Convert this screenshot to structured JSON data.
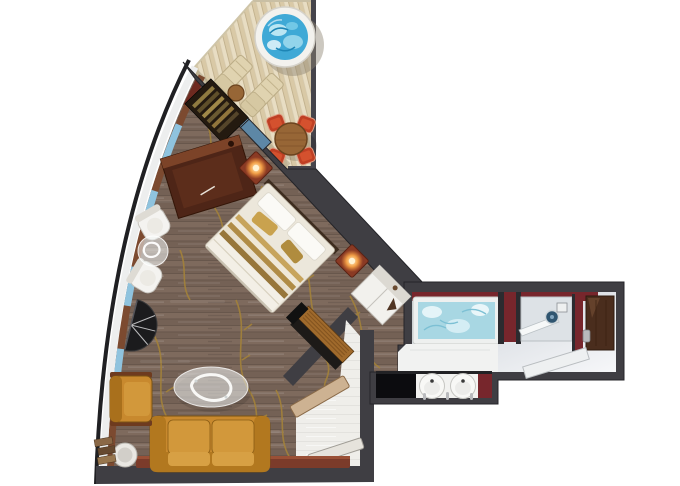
{
  "plan": {
    "type": "cruise-suite-floor-plan",
    "rooms": [
      "balcony",
      "living-bedroom",
      "entry-hall",
      "bathroom"
    ],
    "furniture": {
      "balcony": [
        "hot-tub",
        "sun-lounger",
        "sun-lounger",
        "patio-side-table",
        "dining-table",
        "patio-chairs"
      ],
      "living": [
        "hanging-closet",
        "desk",
        "desk-chair",
        "white-armchair",
        "white-armchair",
        "glass-side-table",
        "fan-table",
        "bed",
        "nightstand-lamp",
        "nightstand-lamp",
        "wardrobe",
        "tv-console",
        "sofa",
        "armchair",
        "coffee-table",
        "round-side-table",
        "magazine-stack",
        "window-ledge"
      ],
      "entry": [
        "bench",
        "door-leaf"
      ],
      "bathroom": [
        "bathtub",
        "shower",
        "showerhead",
        "glass-door",
        "double-sinks",
        "black-counter",
        "shelf-bench",
        "entrance-door"
      ]
    }
  },
  "colors": {
    "page_bg": "#ffffff",
    "wall": "#3f3e43",
    "wall_edge": "#232227",
    "deck_base": "#e8ddc3",
    "deck_stripe": "#d9c9a6",
    "deck_rail": "#45444b",
    "hull_outer": "#202023",
    "hull_white": "#edeeee",
    "hull_wood": "#7c4a30",
    "hull_window": "#8fc3de",
    "hull_accent": "#6e2a20",
    "hot_tub_water": "#3fa9d6",
    "hot_tub_rim": "#f3f2ee",
    "lounger": "#e0d3b0",
    "patio_chair": "#bf3f24",
    "patio_table": "#976636",
    "floor_base": "#7e6a5d",
    "floor_alt": "#746155",
    "branch_gold": "#a3823a",
    "balcony_glass_a": "#82aecd",
    "balcony_glass_b": "#5d87a6",
    "closet_dark": "#241a10",
    "desk_wood": "#4e2517",
    "chair_white": "#f4f3f0",
    "glass_white": "rgba(244,247,247,0.55)",
    "fan_dark": "#1b1b1d",
    "bed_sheet": "#ece7db",
    "pillow_white": "#fbfaf6",
    "cushion_gold": "#c9a24e",
    "stripe_gold": "#b08c46",
    "stripe_cream": "#efe8d8",
    "nightstand": "#8a3a24",
    "lamp_core": "#fff3d4",
    "lamp_mid": "#ffae4e",
    "wardrobe_white": "#f2f1ed",
    "console_top": "#a06a2c",
    "console_front": "#1d1a18",
    "sofa_body": "#c8892e",
    "sofa_cushion": "#d2983b",
    "sofa_trim": "#6e3b1f",
    "ledge_red": "#7b3b2a",
    "entry_floor": "#efeeea",
    "entry_bench": "#cdb292",
    "entry_leaf": "#e6e3dc",
    "bath_red": "#77262c",
    "bath_floor_a": "#c9cfd6",
    "bath_floor_b": "#f6f7f9",
    "tub_water": "#a8d7e3",
    "tub_rim": "#eef0ef",
    "tub_front": "#f1f2f1",
    "sink_white": "#f8f8f6",
    "counter_black": "#0c0c0f",
    "shower_tray": "#dde2e6",
    "showerhead": "#2f5570",
    "door_brown": "#4a2d1d",
    "chrome": "#b9babd"
  }
}
